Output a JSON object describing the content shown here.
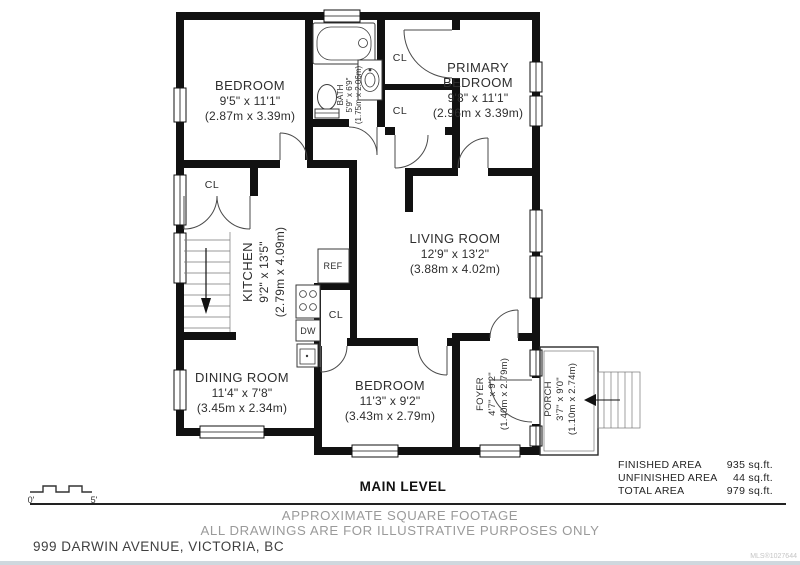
{
  "plan": {
    "level_title": "MAIN LEVEL",
    "scale": {
      "start": "0'",
      "end": "5'"
    },
    "rooms": {
      "bedroom1": {
        "name": "BEDROOM",
        "imperial": "9'5\" x 11'1\"",
        "metric": "(2.87m x 3.39m)"
      },
      "bath": {
        "name": "BATH",
        "imperial": "5'9\" x 6'9\"",
        "metric": "(1.75m x 2.06m)"
      },
      "primary_bedroom": {
        "name_line1": "PRIMARY",
        "name_line2": "BEDROOM",
        "imperial": "9'8\" x 11'1\"",
        "metric": "(2.96m x 3.39m)"
      },
      "kitchen": {
        "name": "KITCHEN",
        "imperial": "9'2\" x 13'5\"",
        "metric": "(2.79m x 4.09m)"
      },
      "living_room": {
        "name": "LIVING ROOM",
        "imperial": "12'9\" x 13'2\"",
        "metric": "(3.88m x 4.02m)"
      },
      "dining_room": {
        "name": "DINING ROOM",
        "imperial": "11'4\" x 7'8\"",
        "metric": "(3.45m x 2.34m)"
      },
      "bedroom2": {
        "name": "BEDROOM",
        "imperial": "11'3\" x 9'2\"",
        "metric": "(3.43m x 2.79m)"
      },
      "foyer": {
        "name": "FOYER",
        "imperial": "4'7\" x 9'2\"",
        "metric": "(1.40m x 2.79m)"
      },
      "porch": {
        "name": "PORCH",
        "imperial": "3'7\" x 9'0\"",
        "metric": "(1.10m x 2.74m)"
      }
    },
    "fixtures": {
      "closet": "CL",
      "refrigerator": "REF",
      "dishwasher": "DW"
    }
  },
  "areas": {
    "rows": [
      {
        "label": "FINISHED AREA",
        "value": "935 sq.ft."
      },
      {
        "label": "UNFINISHED AREA",
        "value": "44 sq.ft."
      },
      {
        "label": "TOTAL AREA",
        "value": "979 sq.ft."
      }
    ]
  },
  "footer": {
    "disclaimer_line1": "APPROXIMATE SQUARE FOOTAGE",
    "disclaimer_line2": "ALL DRAWINGS ARE FOR ILLUSTRATIVE PURPOSES ONLY",
    "address": "999 DARWIN AVENUE, VICTORIA, BC",
    "watermark": "MLS®1027644"
  },
  "colors": {
    "wall": "#111111",
    "text": "#2e2e2e",
    "muted": "#9a9a9a"
  }
}
